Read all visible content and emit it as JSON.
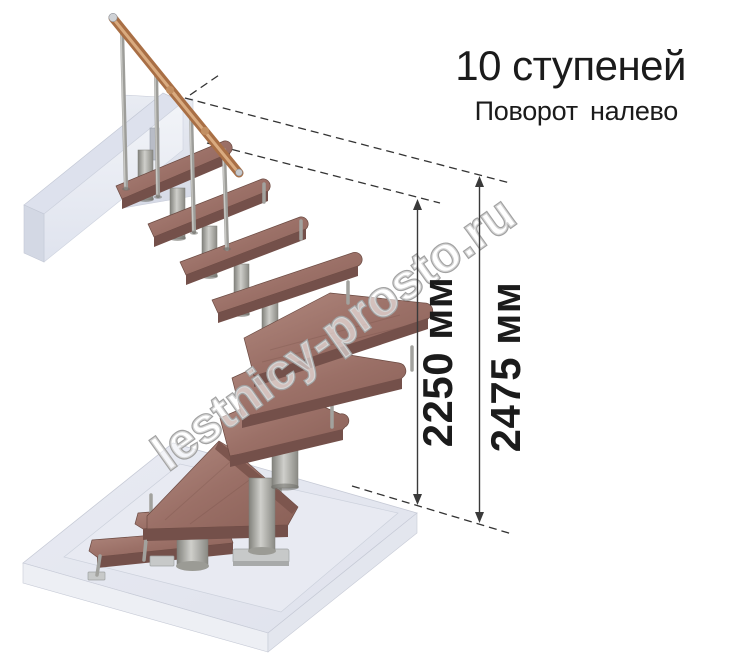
{
  "header": {
    "title": "10 ступеней",
    "subtitle": "Поворот налево"
  },
  "staircase": {
    "steps_count": 10,
    "turn_direction": "налево"
  },
  "dimensions": {
    "height_to_top_step": {
      "label": "2250 мм",
      "value": 2250,
      "unit": "мм"
    },
    "height_to_ceiling": {
      "label": "2475 мм",
      "value": 2475,
      "unit": "мм"
    }
  },
  "watermark": {
    "text": "lestnicy-prosto.ru"
  },
  "colors": {
    "background": "#ffffff",
    "text": "#1b1b1b",
    "dimension_line": "#3a3a3a",
    "tread_wood": "#9b7067",
    "tread_front": "#74504a",
    "handrail_copper": "#a96f45",
    "metal": "#9d9d99",
    "slab": "#e4e7f0",
    "watermark_outline": "#a2a2a2"
  }
}
